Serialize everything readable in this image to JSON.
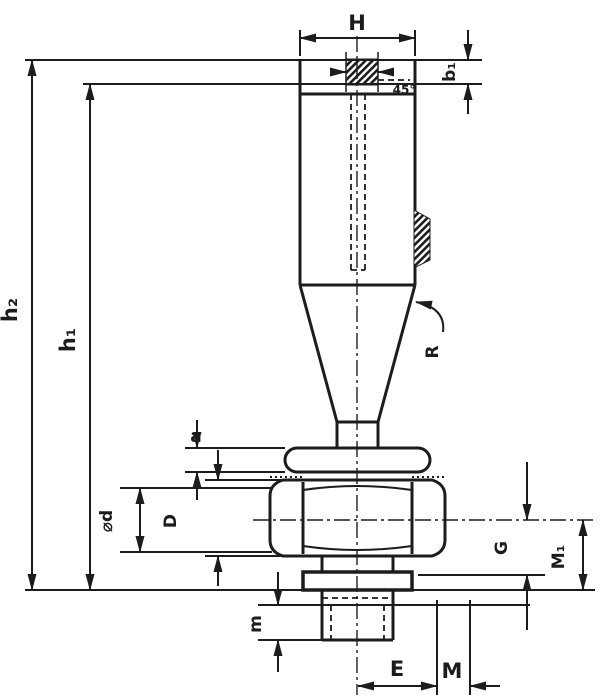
{
  "drawing": {
    "description": "Technical dimension drawing of a knurled hand knob with tapered shank, collar, hex nut, washer and threaded stud",
    "line_color": "#1c1c1c",
    "background_color": "#ffffff",
    "labels": {
      "H": "H",
      "b1": "b₁",
      "h2": "h₂",
      "h1": "h₁",
      "R": "R",
      "deg45": "45°",
      "a": "a",
      "phi_d": "⌀d",
      "D": "D",
      "G": "G",
      "M1": "M₁",
      "m": "m",
      "E": "E",
      "M": "M"
    }
  }
}
